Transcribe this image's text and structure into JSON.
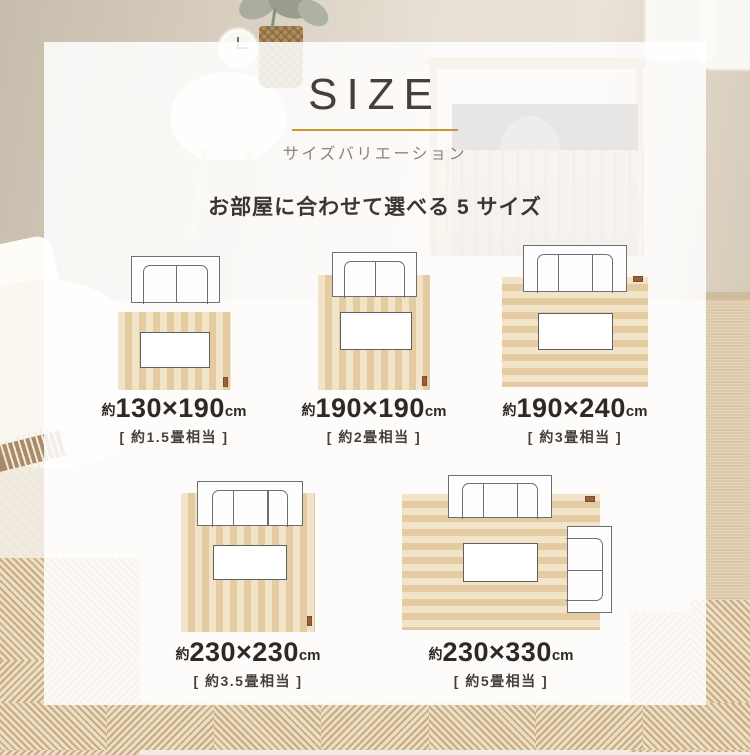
{
  "header": {
    "title": "SIZE",
    "subtitle": "サイズバリエーション",
    "lead": "お部屋に合わせて選べる 5 サイズ",
    "accent_color": "#c89733"
  },
  "sizes": [
    {
      "prefix": "約",
      "dims": "130×190",
      "unit": "cm",
      "tatami": "[ 約1.5畳相当 ]"
    },
    {
      "prefix": "約",
      "dims": "190×190",
      "unit": "cm",
      "tatami": "[ 約2畳相当 ]"
    },
    {
      "prefix": "約",
      "dims": "190×240",
      "unit": "cm",
      "tatami": "[ 約3畳相当 ]"
    },
    {
      "prefix": "約",
      "dims": "230×230",
      "unit": "cm",
      "tatami": "[ 約3.5畳相当 ]"
    },
    {
      "prefix": "約",
      "dims": "230×330",
      "unit": "cm",
      "tatami": "[ 約5畳相当 ]"
    }
  ],
  "colors": {
    "rug_stripe_light": "#f1e4c9",
    "rug_stripe_dark": "#e4cba1",
    "rug_tag": "#96613c",
    "text_dark": "#2d2926",
    "text_gray": "#8a847e",
    "card_bg": "rgba(255,255,255,0.85)"
  }
}
